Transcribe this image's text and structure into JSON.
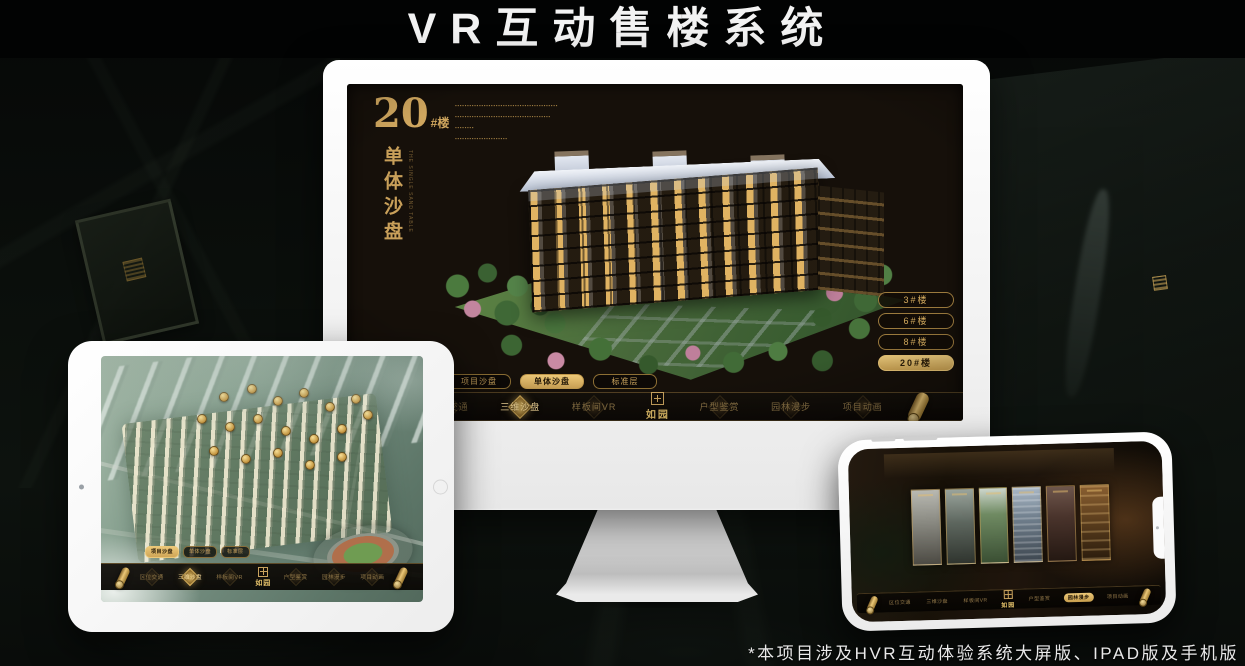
{
  "page": {
    "title": "VR互动售楼系统",
    "footnote": "*本项目涉及HVR互动体验系统大屏版、IPAD版及手机版"
  },
  "brand": {
    "name": "如园"
  },
  "nav_menu": {
    "items": [
      "区位交通",
      "三维沙盘",
      "样板间VR",
      "户型鉴赏",
      "园林漫步",
      "项目动画"
    ]
  },
  "desktop_app": {
    "heading": {
      "number": "20",
      "unit": "#楼",
      "subtitle_vertical": "单体沙盘",
      "subtitle_caption": "THE SINGLE SAND TABLE"
    },
    "intro_lines": [
      "▪▪▪▪▪▪▪▪▪▪▪▪▪▪▪▪▪▪▪▪▪▪▪▪▪▪▪▪▪▪▪▪▪▪▪▪▪▪▪▪▪▪▪",
      "▪▪▪▪▪▪▪▪▪▪▪▪▪▪▪▪▪▪▪▪▪▪▪▪▪▪▪▪▪▪▪▪▪▪▪▪▪▪▪▪",
      "▪▪▪▪▪▪▪▪",
      "▪▪▪▪▪▪▪▪▪▪▪▪▪▪▪▪▪▪▪▪▪▪"
    ],
    "building_buttons": [
      {
        "label": "3#楼"
      },
      {
        "label": "6#楼"
      },
      {
        "label": "8#楼"
      },
      {
        "label": "20#楼",
        "active": true
      }
    ],
    "subtabs": [
      {
        "label": "项目沙盘"
      },
      {
        "label": "单体沙盘",
        "active": true
      },
      {
        "label": "标准层"
      }
    ],
    "nav_active": "三维沙盘"
  },
  "ipad_app": {
    "subtabs": [
      {
        "label": "项目沙盘",
        "active": true
      },
      {
        "label": "单体沙盘"
      },
      {
        "label": "标准层"
      }
    ],
    "nav_active": "三维沙盘"
  },
  "phone_app": {
    "nav_active": "园林漫步"
  },
  "colors": {
    "gold": "#d2ab62",
    "gold_bright": "#ecc878",
    "screen_bg": "#16100a",
    "nav_bg": "#120d07",
    "title_white": "#f3f3f3"
  }
}
